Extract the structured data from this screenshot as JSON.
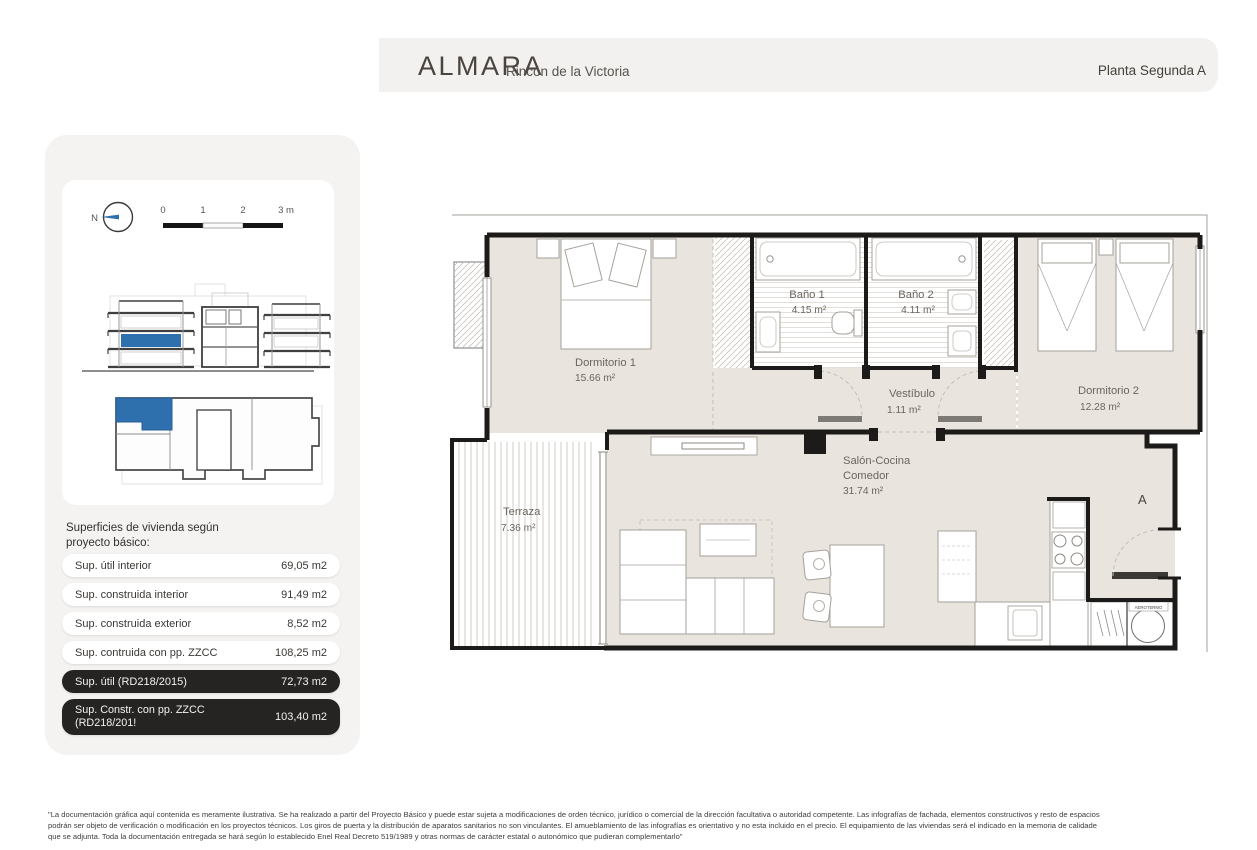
{
  "header": {
    "brand": "ALMARA",
    "location": "Rincón de la Victoria",
    "plan_label": "Planta Segunda A"
  },
  "key_plan": {
    "compass_label": "N",
    "scale_ticks": [
      "0",
      "1",
      "2",
      "3 m"
    ]
  },
  "surfaces": {
    "title_line1": "Superficies de vivienda según",
    "title_line2": "proyecto básico:",
    "rows": [
      {
        "label": "Sup. útil interior",
        "value": "69,05 m2"
      },
      {
        "label": "Sup. construida interior",
        "value": "91,49 m2"
      },
      {
        "label": "Sup. construida exterior",
        "value": "8,52 m2"
      },
      {
        "label": "Sup. contruida con pp. ZZCC",
        "value": "108,25 m2"
      },
      {
        "label": "Sup. útil (RD218/2015)",
        "value": "72,73 m2"
      },
      {
        "label": "Sup. Constr. con pp. ZZCC",
        "label_line2": "(RD218/201!",
        "value": "103,40 m2"
      }
    ]
  },
  "floor_plan": {
    "rooms": [
      {
        "name": "Dormitorio 1",
        "area": "15.66 m²"
      },
      {
        "name": "Baño 1",
        "area": "4.15 m²"
      },
      {
        "name": "Baño 2",
        "area": "4.11 m²"
      },
      {
        "name": "Vestíbulo",
        "area": "1.11 m²"
      },
      {
        "name": "Dormitorio 2",
        "area": "12.28 m²"
      },
      {
        "name": "Salón-Cocina",
        "name_line2": "Comedor",
        "area": "31.74 m²"
      },
      {
        "name": "Terraza",
        "area": "7.36 m²"
      }
    ],
    "entrance_label": "A",
    "equipment_label": "AEROTERMO"
  },
  "footer": {
    "lines": [
      "\"La documentación gráfica aquí contenida es meramente ilustrativa. Se ha realizado a partir del Proyecto Básico y puede estar sujeta a modificaciones de orden técnico, jurídico o comercial de la dirección facultativa o autoridad competente. Las infografías de fachada, elementos constructivos y resto de espacios",
      "podrán ser objeto de verificación o modificación en los proyectos técnicos. Los giros de puerta y la distribución de aparatos sanitarios no son vinculantes. El amueblamiento de las infografías es orientativo y no esta incluido en el precio. El equipamiento de las viviendas será el indicado en la memoria de calidade",
      "que se adjunta. Toda la documentación entregada se hará según lo establecido Enel Real Decreto 519/1989 y otras normas de carácter estatal o autonómico que pudieran complementarlo\""
    ]
  },
  "colors": {
    "accent_blue": "#2e6fae",
    "room_fill": "#eae4de",
    "wall": "#1c1b19",
    "header_bg": "#f2f1ef",
    "panel_bg": "#f4f3f1",
    "dark_pill": "#252422"
  }
}
